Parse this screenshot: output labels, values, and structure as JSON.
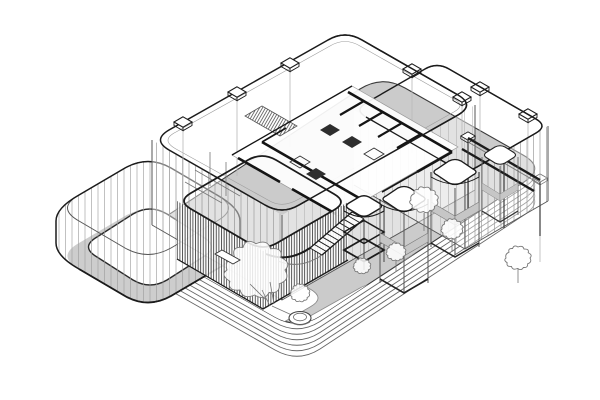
{
  "page": {
    "background": "#ffffff"
  },
  "colors": {
    "line_dark": "#1b1b1b",
    "line_mid": "#555555",
    "line_soft": "#777777",
    "line_light": "#9c9c9c",
    "line_faint": "#b8b8b8",
    "plaza_gray": "#cbcbcb",
    "floor_gray": "#cdcdcd",
    "band_gray": "#c6c6c6",
    "white": "#ffffff",
    "fixture_dark": "#2e2e2e"
  },
  "scene": {
    "type": "architectural-axonometric-wireframe-drawing",
    "podium": {
      "terrace_layers": 6,
      "layer_offset_px": 5.5
    },
    "elements": [
      {
        "name": "stepped-podium-base",
        "description": "rounded rectangular plinth of stacked terraced slabs"
      },
      {
        "name": "plaza-deck",
        "description": "gray deck with white rounded garden paths"
      },
      {
        "name": "rounded-courtyard-annex",
        "description": "glass rounded-square enclosure with inner courtyard"
      },
      {
        "name": "main-glass-hall",
        "description": "large rounded glass volume, mullioned curtain wall, roof columns with caps"
      },
      {
        "name": "secondary-glass-hall",
        "description": "rear-right glass volume with beam pergola"
      },
      {
        "name": "interior-core-rooms",
        "description": "floor plate with dark partition walls, door gaps and fixtures"
      },
      {
        "name": "hatched-ramp",
        "description": "densely hatched sloped element inside the hall"
      },
      {
        "name": "louvered-pavilion",
        "description": "densely striped louver box with external stair and curved rail"
      },
      {
        "name": "stair-tower",
        "description": "slender framed tower beside the stair"
      },
      {
        "name": "roof-pavilions",
        "description": "three small column pavilions with banded caps"
      },
      {
        "name": "landscape",
        "description": "scribbled trees, shrubs, planter pot and bench"
      }
    ]
  }
}
